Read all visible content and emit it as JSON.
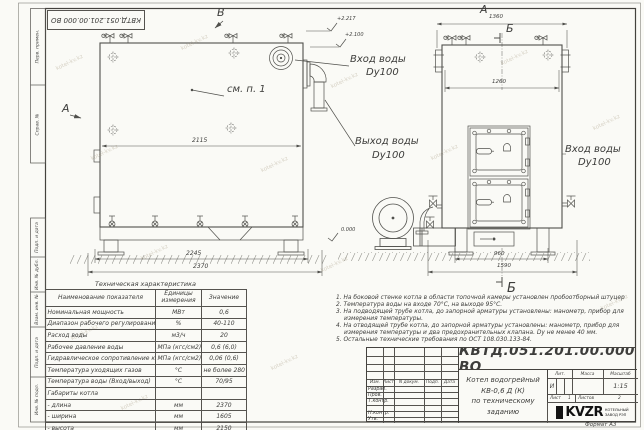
{
  "watermark": {
    "text": "kotel-kv.kz"
  },
  "frame": {
    "top_stamp_code": "КВТД.051.201.00.000 ВО",
    "left_labels": [
      "Перв. примен.",
      "Справ. №",
      "Подп. и дата",
      "Инв. № дубл.",
      "Взам. инв. №",
      "Подп. и дата",
      "Инв. № подл."
    ]
  },
  "drawing": {
    "labels": {
      "a": "А",
      "b": "Б",
      "v": "В",
      "see_note": "см. п. 1"
    },
    "callouts": {
      "inlet": "Вход воды",
      "outlet": "Выход воды",
      "dn": "Dy100"
    },
    "elevations": {
      "e1": "+2.217",
      "e2": "+2.100",
      "zero": "0.000"
    },
    "dims": {
      "side_top": "2115",
      "side_base": "2245",
      "side_overall": "2370",
      "front_top": "1360",
      "front_inner": "1260",
      "front_base": "960",
      "front_overall": "1590"
    }
  },
  "table": {
    "title": "Техническая характеристика",
    "headers": [
      "Наименование показателя",
      "Единицы измерения",
      "Значение"
    ],
    "rows": [
      [
        "Номинальная мощность",
        "МВт",
        "0,6"
      ],
      [
        "Диапазон рабочего регулирования",
        "%",
        "40-110"
      ],
      [
        "Расход воды",
        "м3/ч",
        "20"
      ],
      [
        "Рабочее давление воды",
        "МПа (кгс/см2)",
        "0,6 (6,0)"
      ],
      [
        "Гидравлическое сопротивление котла",
        "МПа (кгс/см2)",
        "0,06 (0,6)"
      ],
      [
        "Температура уходящих газов",
        "°С",
        "не более 280"
      ],
      [
        "Температура воды (Вход/выход)",
        "°С",
        "70/95"
      ],
      [
        "Габариты котла",
        "",
        ""
      ],
      [
        "- длина",
        "мм",
        "2370"
      ],
      [
        "- ширина",
        "мм",
        "1605"
      ],
      [
        "- высота",
        "мм",
        "2150"
      ]
    ]
  },
  "notes": [
    "1. На боковой стенке котла в области топочной камеры установлен пробоотборный штуцер",
    "2. Температура воды на входе 70°С, на выходе 95°С.",
    "3. На подводящей трубе котла, до запорной арматуры установлены: манометр, прибор для измерения температуры.",
    "4. На отводящей трубе котла, до запорной арматуры установлены: манометр, прибор для измерения температуры и два предохранительных клапана. Dу не менее 40 мм.",
    "5. Остальные технические требования по ОСТ 108.030.133-84."
  ],
  "title_block": {
    "code": "КВТД.051.201.00.000 ВО",
    "name_line1": "Котел водогрейный",
    "name_line2": "КВ-0,6 Д (К)",
    "name_line3": "по техническому заданию",
    "cols": [
      "Изм.",
      "Лист",
      "N докум.",
      "Подп.",
      "Дата"
    ],
    "rows": [
      "Разраб.",
      "Пров.",
      "Т.контр.",
      "",
      "Н.контр.",
      "Утв."
    ],
    "lit_label": "Лит.",
    "lit_value": "И",
    "mass_label": "Масса",
    "scale_label": "Масштаб",
    "scale_value": "1:15",
    "sheet_label": "Лист",
    "sheet_value": "1",
    "sheets_label": "Листов",
    "sheets_value": "2",
    "logo": "KVZR",
    "logo_sub1": "КОТЕЛЬНЫЙ",
    "logo_sub2": "ЗАВОД РЭП",
    "format": "Формат  А3"
  }
}
